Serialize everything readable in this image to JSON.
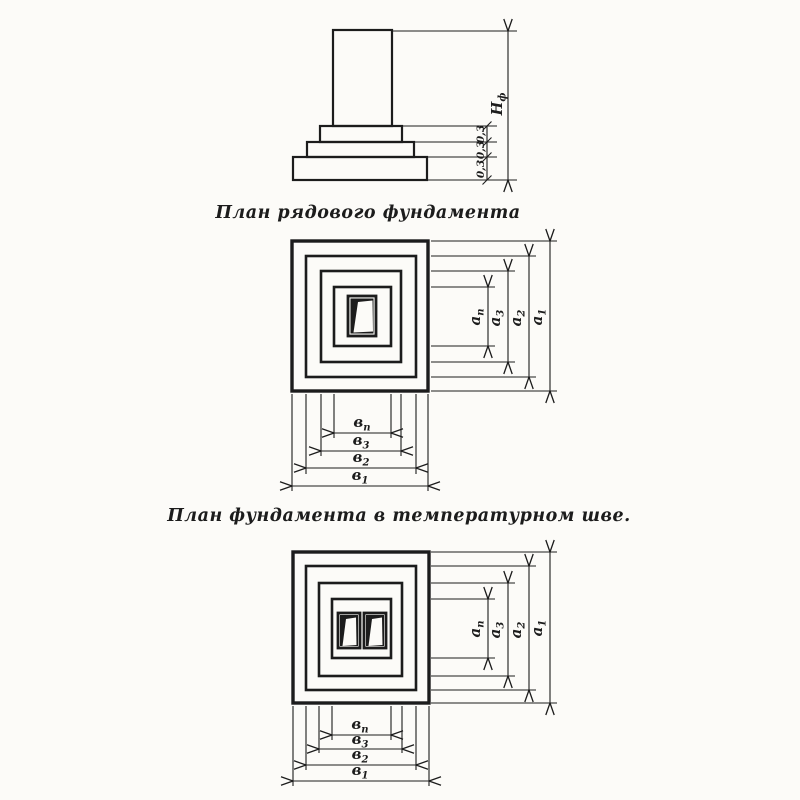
{
  "drawing": {
    "background_color": "#fcfbf8",
    "ink_color": "#1c1c1c",
    "elevation": {
      "description": "column-foundation-elevation-section",
      "height_dim": {
        "main": "Н",
        "sub": "ф"
      },
      "step_dims": [
        "0,3",
        "0,3",
        "0,3"
      ]
    },
    "plan_ordinary": {
      "title": "План рядового фундамента",
      "side_dims": [
        {
          "main": "а",
          "sub": "п"
        },
        {
          "main": "а",
          "sub": "3"
        },
        {
          "main": "а",
          "sub": "2"
        },
        {
          "main": "а",
          "sub": "1"
        }
      ],
      "bottom_dims": [
        {
          "main": "в",
          "sub": "п"
        },
        {
          "main": "в",
          "sub": "3"
        },
        {
          "main": "в",
          "sub": "2"
        },
        {
          "main": "в",
          "sub": "1"
        }
      ]
    },
    "plan_joint": {
      "title": "План фундамента в температурном шве.",
      "side_dims": [
        {
          "main": "а",
          "sub": "п"
        },
        {
          "main": "а",
          "sub": "3"
        },
        {
          "main": "а",
          "sub": "2"
        },
        {
          "main": "а",
          "sub": "1"
        }
      ],
      "bottom_dims": [
        {
          "main": "в",
          "sub": "п"
        },
        {
          "main": "в",
          "sub": "3"
        },
        {
          "main": "в",
          "sub": "2"
        },
        {
          "main": "в",
          "sub": "1"
        }
      ]
    }
  }
}
